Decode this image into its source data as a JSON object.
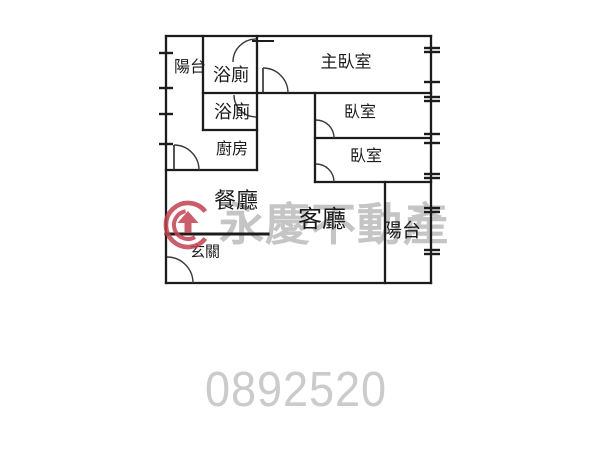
{
  "page": {
    "background": "#ffffff"
  },
  "floorplan": {
    "line_color": "#1c1c1c",
    "room_labels": [
      {
        "name": "balcony-left",
        "label": "陽台"
      },
      {
        "name": "bathroom-upper",
        "label": "浴廁"
      },
      {
        "name": "bathroom-lower",
        "label": "浴廁"
      },
      {
        "name": "master-bedroom",
        "label": "主臥室"
      },
      {
        "name": "bedroom-1",
        "label": "臥室"
      },
      {
        "name": "bedroom-2",
        "label": "臥室"
      },
      {
        "name": "kitchen",
        "label": "廚房"
      },
      {
        "name": "dining-room",
        "label": "餐廳"
      },
      {
        "name": "living-room",
        "label": "客廳"
      },
      {
        "name": "entryway",
        "label": "玄關"
      },
      {
        "name": "balcony-right",
        "label": "陽台"
      }
    ]
  },
  "watermark": {
    "brand_text": "永慶不動產",
    "logo_icon": "yungching-circle-arrow-logo",
    "logo_color": "#c4414f",
    "text_color": "#c5c5c5"
  },
  "footer": {
    "listing_number": "0892520",
    "number_color": "#cbcbcb"
  }
}
